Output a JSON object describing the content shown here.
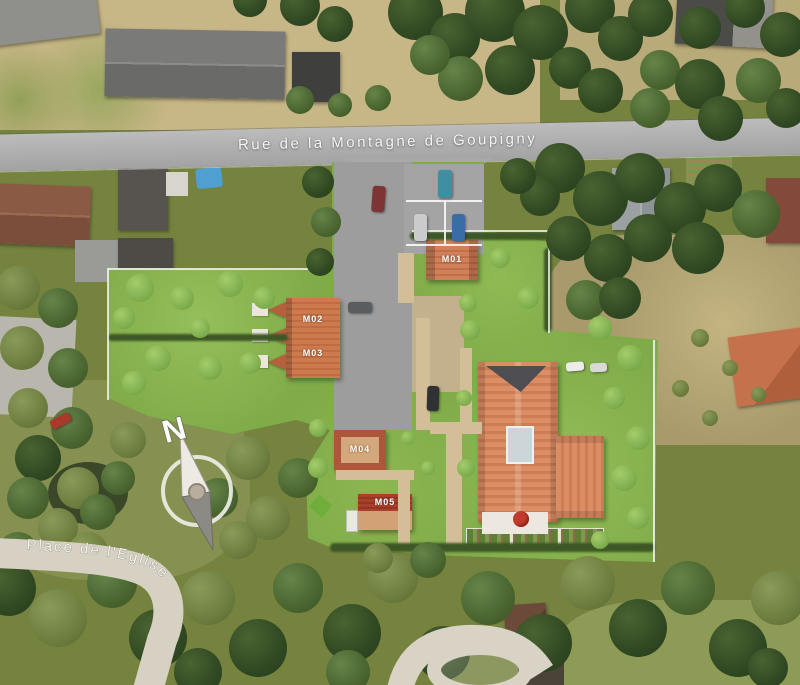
{
  "map": {
    "description": "aerial-site-plan",
    "streets": {
      "main_road": "Rue de la Montagne de Goupigny",
      "bottom_left_road": "Place de l'Eglise"
    },
    "compass": {
      "north": "N"
    },
    "buildings": [
      {
        "id": "M01"
      },
      {
        "id": "M02"
      },
      {
        "id": "M03"
      },
      {
        "id": "M04"
      },
      {
        "id": "M05"
      }
    ],
    "colors": {
      "site_green": "#7fab49",
      "photo_green": "#75833f",
      "tree_dark": "#2f4722",
      "dry_grass_tan": "#c7b686",
      "road_gray": "#a8a8a8",
      "concrete_light": "#d6d1c3",
      "roof_terracotta": "#d3815a",
      "roof_orange": "#c9744a",
      "roof_dark_red": "#a8402e",
      "label_white": "#ffffff"
    }
  }
}
